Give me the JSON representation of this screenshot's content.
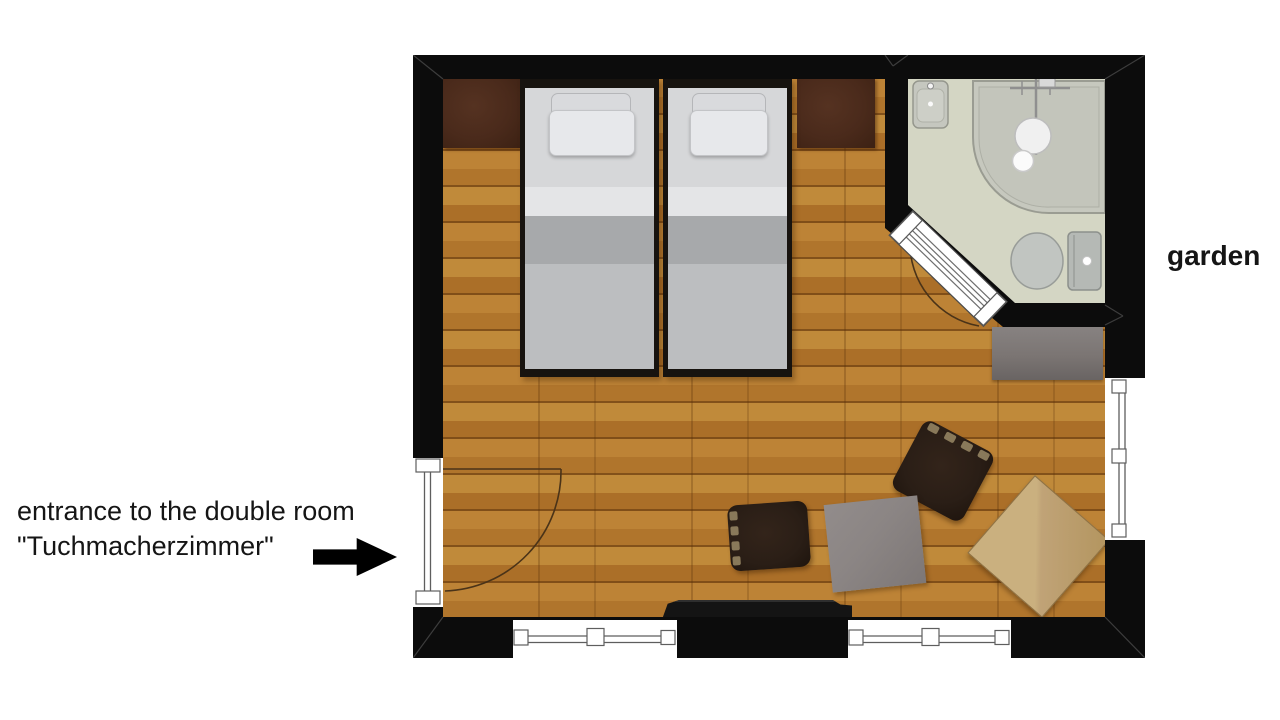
{
  "labels": {
    "entrance_line1": "entrance to the double room",
    "entrance_line2": "\"Tuchmacherzimmer\"",
    "garden": "garden"
  },
  "icons": {
    "entrance_arrow": "right-arrow"
  },
  "colors": {
    "wall": "#0c0c0c",
    "floor": "#b3782e",
    "bath": "#d4d6c4",
    "headboard": "#4a2a1b",
    "sheet": "#d6d7d9",
    "blanket": "#a7a9ab",
    "duvet": "#bcbec0",
    "chair": "#2a1e16",
    "graytable": "#8b8584",
    "woodtable": "#c0a377",
    "dresser": "#7b7573",
    "arc": "#4a3318",
    "arrow": "#000000",
    "text": "#151515"
  }
}
